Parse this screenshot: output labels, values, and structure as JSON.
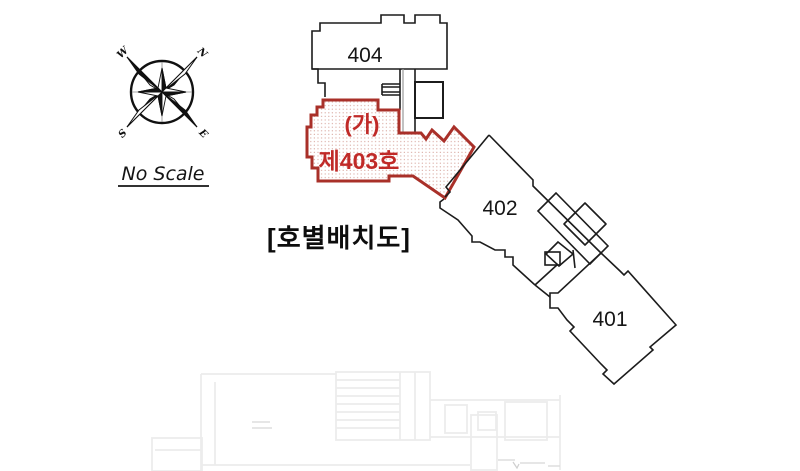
{
  "diagram": {
    "title": "[호별배치도]",
    "scale_note": "No Scale",
    "compass": {
      "north": "N",
      "south": "S",
      "east": "E",
      "west": "W"
    },
    "units": [
      {
        "id": "404",
        "label": "404"
      },
      {
        "id": "403",
        "label": "제403호",
        "mark": "(가)",
        "highlighted": true
      },
      {
        "id": "402",
        "label": "402"
      },
      {
        "id": "401",
        "label": "401"
      }
    ],
    "colors": {
      "outline": "#1c1c1c",
      "red_outline": "#a93029",
      "red_text": "#c02a28",
      "faint": "#ececec"
    }
  }
}
